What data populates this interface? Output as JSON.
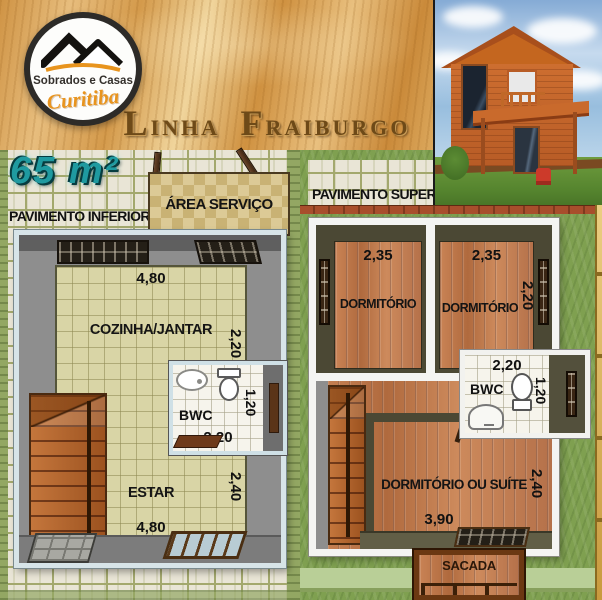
{
  "branding": {
    "logo_title": "Sobrados e Casas",
    "logo_subtitle": "Curitiba",
    "series_word1": "Linha",
    "series_word2": "Fraiburgo",
    "area": "65 m²"
  },
  "lower_floor": {
    "label": "PAVIMENTO INFERIOR",
    "area_servico": "ÁREA SERVIÇO",
    "cozinha": "COZINHA/JANTAR",
    "cozinha_width": "4,80",
    "cozinha_depth": "2,20",
    "bwc": "BWC",
    "bwc_width": "2,20",
    "bwc_depth": "1,20",
    "estar": "ESTAR",
    "estar_width": "4,80",
    "estar_depth": "2,40"
  },
  "upper_floor": {
    "label": "PAVIMENTO SUPERIOR",
    "dorm1": "DORMITÓRIO",
    "dorm1_width": "2,35",
    "dorm2": "DORMITÓRIO",
    "dorm2_width": "2,35",
    "dorm2_depth": "2,20",
    "bwc": "BWC",
    "bwc_width": "2,20",
    "bwc_depth": "1,20",
    "suite": "DORMITÓRIO OU SUÍTE",
    "suite_width": "3,90",
    "suite_depth": "2,40",
    "sacada": "SACADA"
  },
  "colors": {
    "accent_teal": "#1f9aa0",
    "banner_wood": "#d9a558",
    "title_brown": "#6e4a18",
    "logo_orange": "#e8941e",
    "grass_green": "#7fa050",
    "plank_orange": "#c17c4e",
    "tile_beige": "#d9d5a6",
    "wall_gray": "#8e8e8e",
    "wall_olive": "#4b4834",
    "frame_white": "#f4f4f2",
    "frame_blue": "#d7e4e8"
  }
}
